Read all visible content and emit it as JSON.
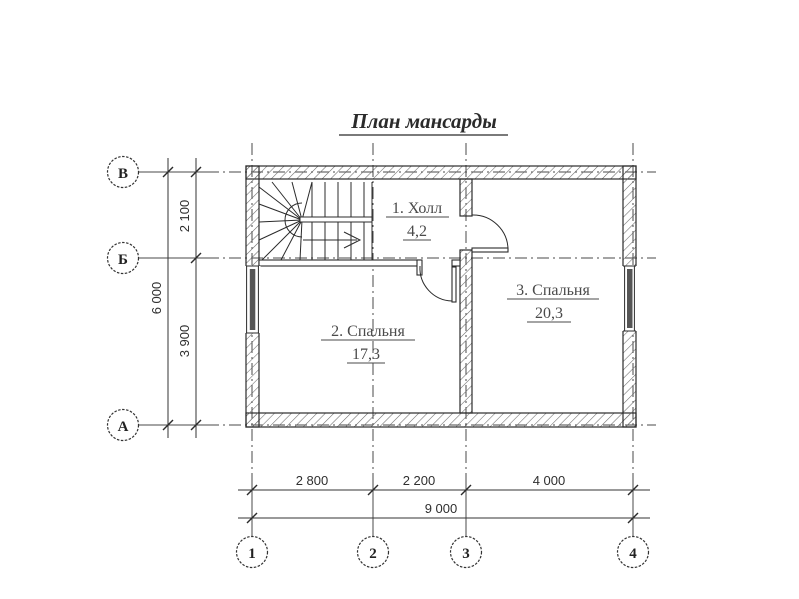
{
  "title": "План мансарды",
  "rooms": [
    {
      "label": "1. Холл",
      "area": "4,2"
    },
    {
      "label": "2. Спальня",
      "area": "17,3"
    },
    {
      "label": "3. Спальня",
      "area": "20,3"
    }
  ],
  "axes": {
    "rows": [
      "В",
      "Б",
      "А"
    ],
    "cols": [
      "1",
      "2",
      "3",
      "4"
    ]
  },
  "dimensions": {
    "left_segments": [
      "2 100",
      "3 900"
    ],
    "left_total": "6 000",
    "bottom_segments": [
      "2 800",
      "2 200",
      "4 000"
    ],
    "bottom_total": "9 000"
  },
  "colors": {
    "ink": "#2b2b2b",
    "background": "#ffffff"
  }
}
